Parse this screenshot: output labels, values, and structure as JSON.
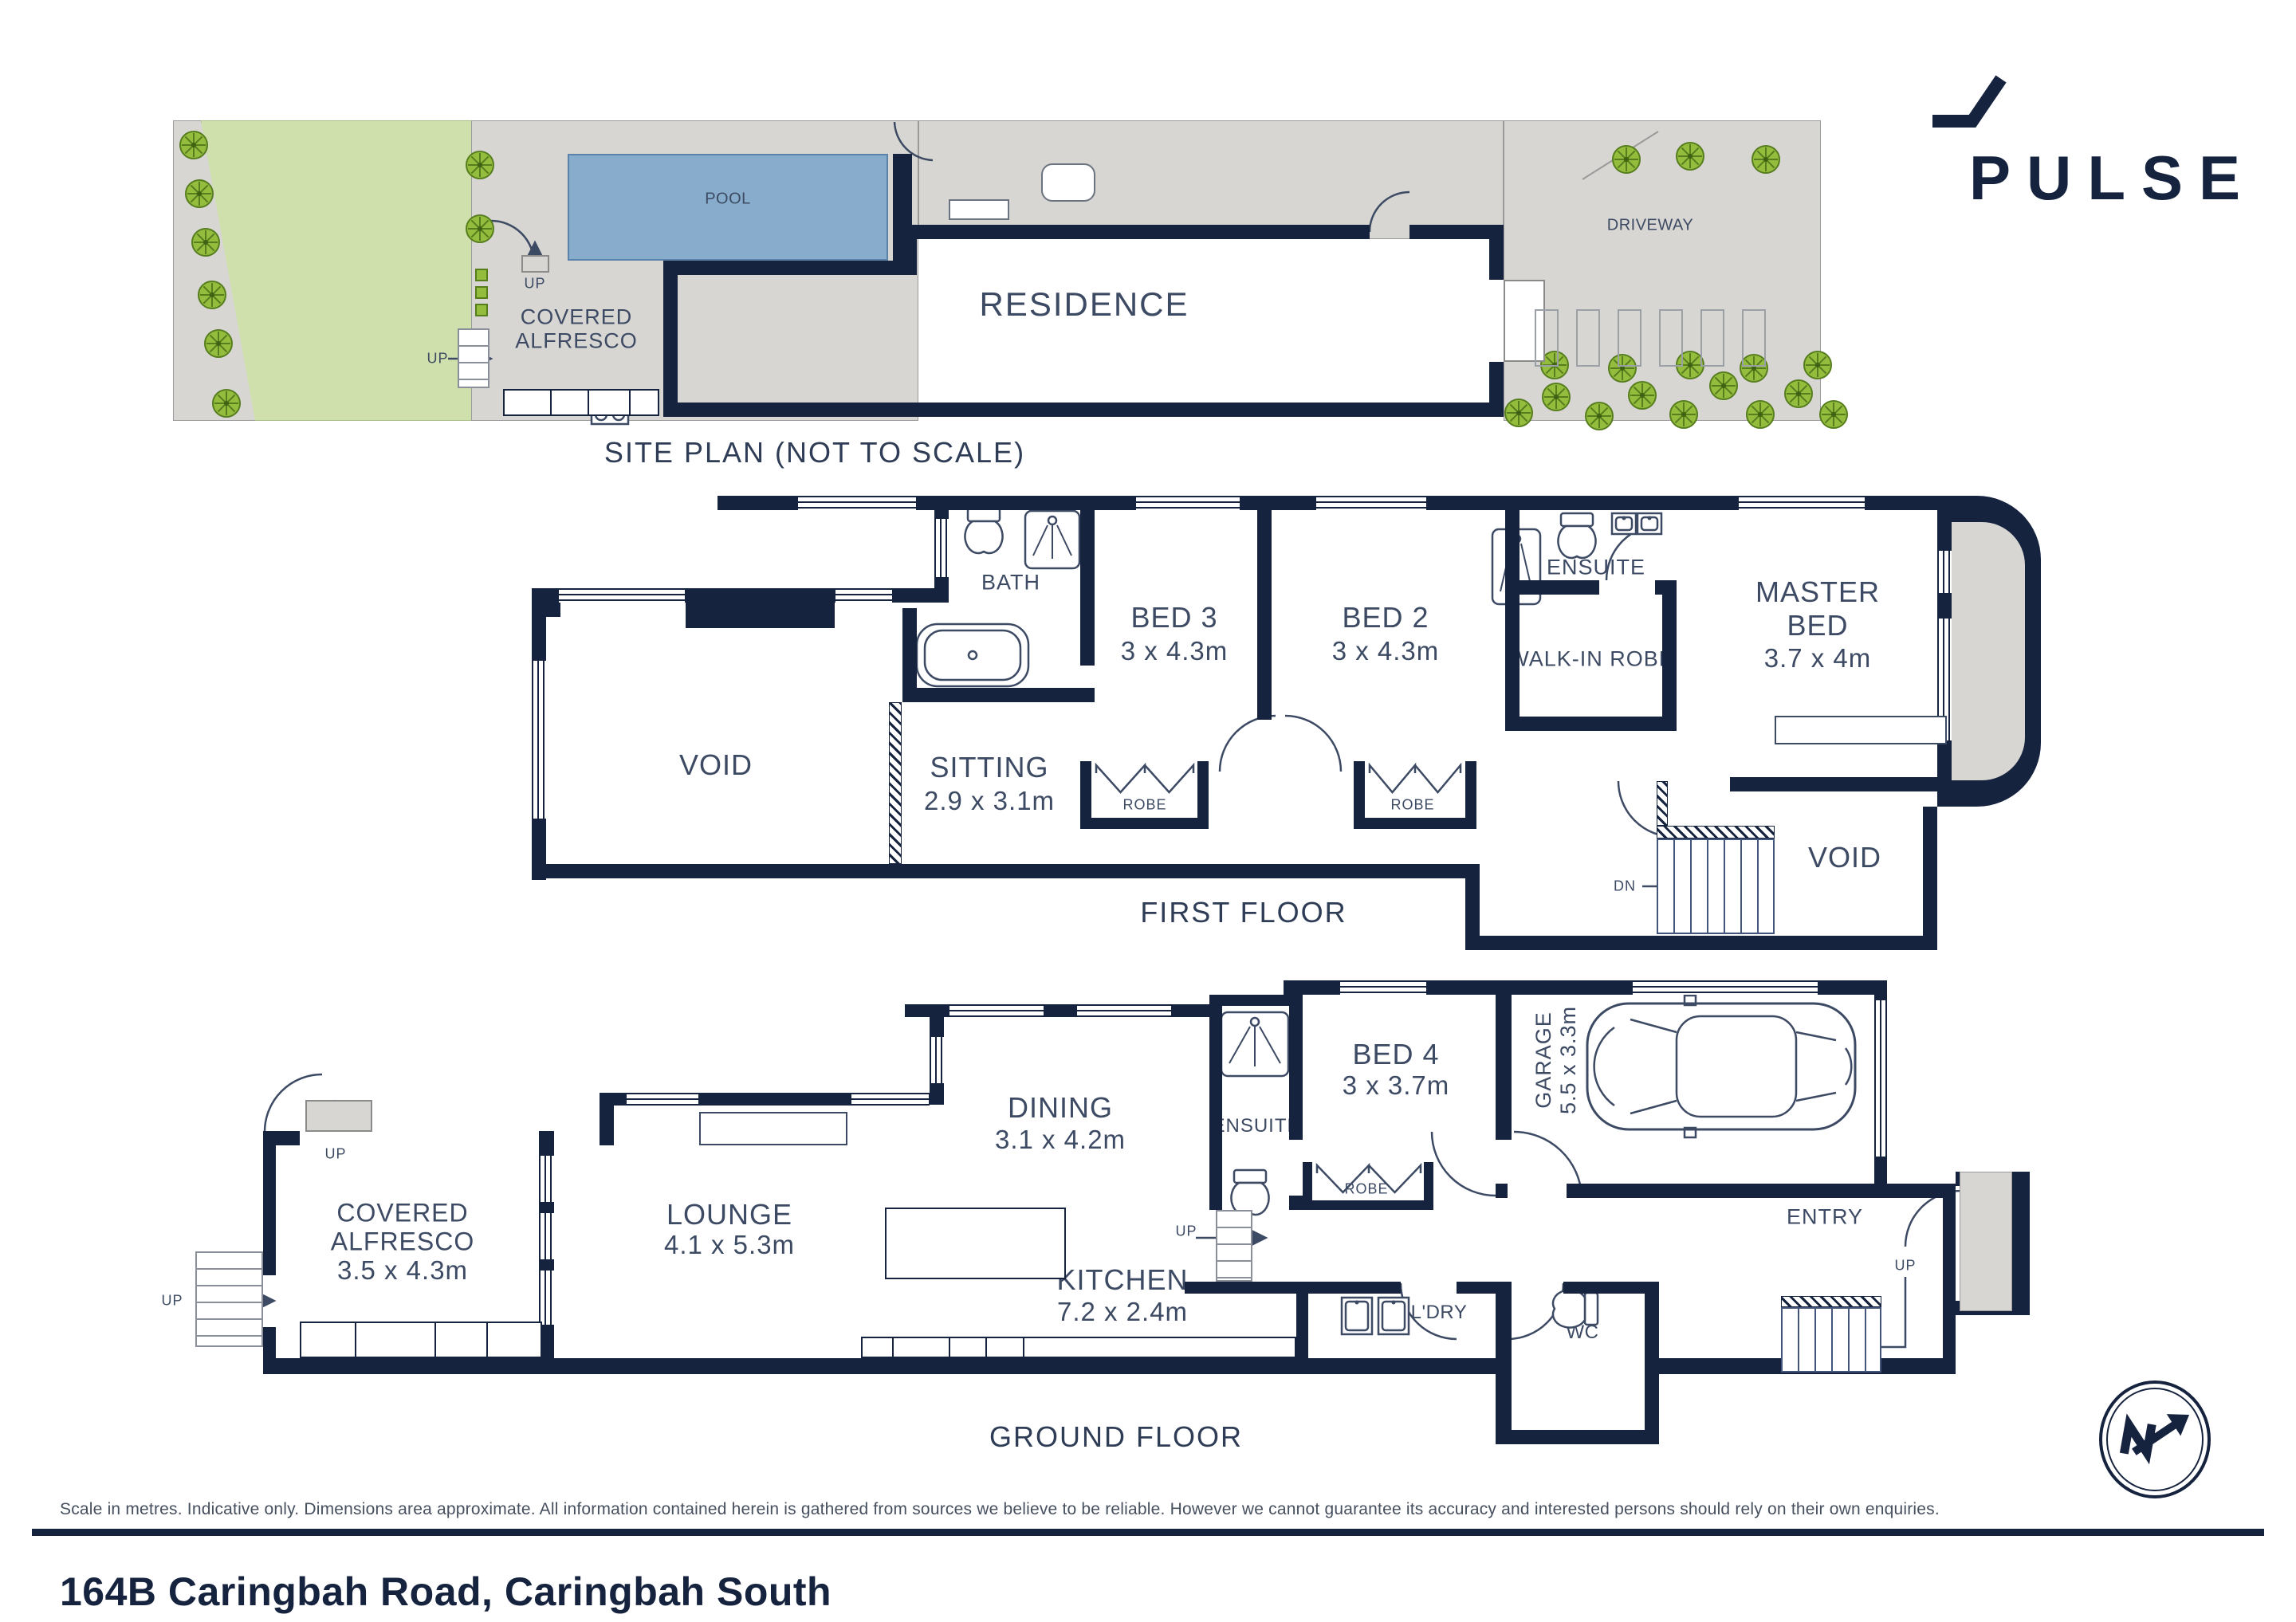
{
  "brand": {
    "logo_text": "PULSE"
  },
  "site_plan": {
    "title": "SITE PLAN (NOT TO SCALE)",
    "residence": "RESIDENCE",
    "pool": "POOL",
    "covered_alfresco_line1": "COVERED",
    "covered_alfresco_line2": "ALFRESCO",
    "driveway": "DRIVEWAY",
    "porch": "PORCH",
    "bbq": "BBQ",
    "ac": "AC",
    "wt": "WT",
    "up": "UP"
  },
  "first_floor": {
    "title": "FIRST FLOOR",
    "void": "VOID",
    "void2": "VOID",
    "sitting": {
      "name": "SITTING",
      "dims": "2.9 x 3.1m"
    },
    "bath": "BATH",
    "bed3": {
      "name": "BED 3",
      "dims": "3 x 4.3m"
    },
    "bed2": {
      "name": "BED 2",
      "dims": "3 x 4.3m"
    },
    "ensuite": "ENSUITE",
    "walk_in_robe": "WALK-IN ROBE",
    "master": {
      "line1": "MASTER",
      "line2": "BED",
      "dims": "3.7 x 4m"
    },
    "balcony": "BALCONY",
    "robe": "ROBE",
    "dn": "DN"
  },
  "ground_floor": {
    "title": "GROUND FLOOR",
    "covered_alfresco": {
      "line1": "COVERED",
      "line2": "ALFRESCO",
      "dims": "3.5 x 4.3m"
    },
    "lounge": {
      "name": "LOUNGE",
      "dims": "4.1 x 5.3m"
    },
    "dining": {
      "name": "DINING",
      "dims": "3.1 x 4.2m"
    },
    "kitchen": {
      "name": "KITCHEN",
      "dims": "7.2 x 2.4m"
    },
    "ensuite": "ENSUITE",
    "bed4": {
      "name": "BED 4",
      "dims": "3 x 3.7m"
    },
    "garage": {
      "name": "GARAGE",
      "dims": "5.5 x 3.3m"
    },
    "laundry": "L'DRY",
    "wc": "WC",
    "entry": "ENTRY",
    "porch": "PORCH",
    "robe": "ROBE",
    "bbq": "BBQ",
    "fp": "FP",
    "fridge": "F",
    "oven": "OV",
    "up": "UP"
  },
  "footer": {
    "disclaimer": "Scale in metres. Indicative only. Dimensions area approximate. All information contained herein is gathered from sources we believe to be reliable. However we cannot guarantee its accuracy and interested persons should rely on their own enquiries.",
    "address": "164B Caringbah Road, Caringbah South"
  },
  "colors": {
    "navy": "#16233f",
    "gray": "#d7d6d3",
    "pool_blue": "#87accc",
    "lawn_green": "#cfe0ac",
    "tree_green": "#95bd3d"
  }
}
